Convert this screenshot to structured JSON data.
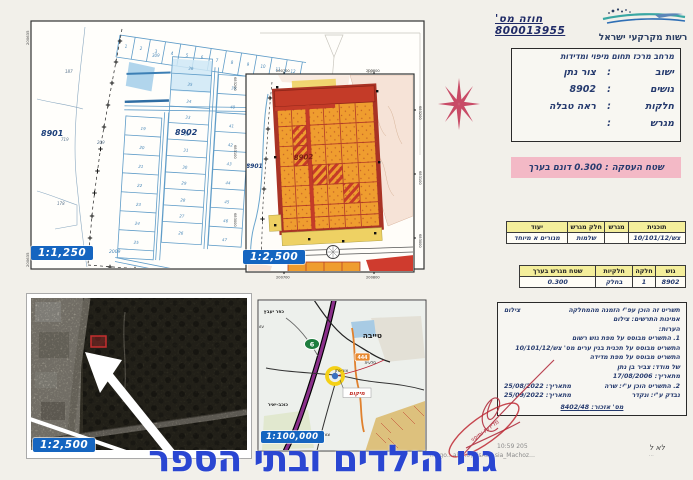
{
  "header": {
    "contract_no": "חוזה מס' 800013955",
    "authority": "רשות מקרקעי ישראל"
  },
  "info_box": {
    "title": "מרחב מרכז תחום מיפוי ומדידות",
    "rows": [
      {
        "label": "ישוב",
        "sep": ":",
        "value": "צור נתן"
      },
      {
        "label": "גושים",
        "sep": ":",
        "value": "8902"
      },
      {
        "label": "חלקות",
        "sep": ":",
        "value": "ראה טבלה"
      },
      {
        "label": "מגרש",
        "sep": ":",
        "value": ""
      }
    ]
  },
  "deal_area_note": "שטח העסקה : 0.300 דונם בערך",
  "plan_table": {
    "headers": [
      "תוכנית",
      "מגרש",
      "חלק מגרש",
      "יעוד"
    ],
    "row": [
      "צש/10/101/12",
      "",
      "שלמות",
      "מגורים א מיוחד"
    ]
  },
  "parcel_table": {
    "headers": [
      "גוש",
      "חלקה",
      "חלקיות",
      "שטח מגרש בערך"
    ],
    "row": [
      "8902",
      "1",
      "בחלק",
      "0.300"
    ]
  },
  "notes_box": {
    "intro": "תשריט זה הוכן עפ\"י הזמנה מהמחלקה",
    "intro_side": "צילום",
    "lines": [
      "אמינות התרשים: צילום",
      "הערות:",
      "1. התשריט מבוסס על מפת גוש רשום",
      "התשריט מבוסס על תכנית בנין ערים מס' צש/10/101/12",
      "התשריט מבוסס על מפת מדידה",
      "של מודד: צביר בן נתן",
      "מתאריך: 17/08/2006"
    ],
    "prepared_by": "2. התשריט הוכן ע\"י: שרה",
    "prepared_date": "מתאריך: 25/08/2022",
    "checked_by": "נבדק ע\"י: ונקדר",
    "checked_date": "מתאריך: 25/09/2022",
    "ref_no": "מס' אזכור: 8402/48"
  },
  "stamp": {
    "text": "מדידות ומיפוי"
  },
  "footer": {
    "headline": "גני הילדים ובתי הספר",
    "timestamp_fragment": "10:59 205",
    "path_fragment": "mi.go…ah…o\\GisAv…sia_Machoz…",
    "corner_note": "לא ל",
    "corner_note_sub": "…"
  },
  "maps": {
    "cadastral": {
      "scale": "1:1,250",
      "corner_coord": "200635",
      "right_coords": [
        "683200",
        "683100",
        "683000"
      ],
      "labels": {
        "g8901": "8901",
        "g8902": "8902",
        "n187": "187",
        "n309": "309",
        "n209": "209",
        "n719": "719",
        "n178": "178",
        "n2009": "2009",
        "faint": "10"
      },
      "top_row": [
        "1",
        "2",
        "3",
        "4",
        "5",
        "6",
        "7",
        "8",
        "9",
        "10",
        "11",
        "12"
      ],
      "left_col": [
        "19",
        "20",
        "21",
        "22",
        "23",
        "24",
        "25"
      ],
      "mid_col": [
        "36",
        "35",
        "34",
        "33",
        "32",
        "31",
        "30",
        "29",
        "28",
        "27",
        "26"
      ],
      "right_col": [
        "39",
        "40",
        "41",
        "42",
        "43",
        "44",
        "45",
        "46",
        "47"
      ]
    },
    "zoning": {
      "scale": "1:2,500",
      "top_coords": [
        "200700",
        "200800"
      ],
      "bottom_coords": [
        "200700",
        "200800"
      ],
      "right_coords": [
        "683200",
        "683100",
        "683000"
      ],
      "labels": {
        "g8901": "8901",
        "g8902": "8902"
      }
    },
    "aerial": {
      "scale": "1:2,500"
    },
    "location": {
      "scale": "1:100,000",
      "marker_label": "מיקום",
      "shields": {
        "hwy6": "6",
        "r444": "444"
      },
      "towns": [
        "כפר יעבץ",
        "עזריאל",
        "טייבה",
        "סלעית",
        "צור-נתן",
        "כוכב-יאיר",
        "צור יצחק"
      ]
    }
  }
}
